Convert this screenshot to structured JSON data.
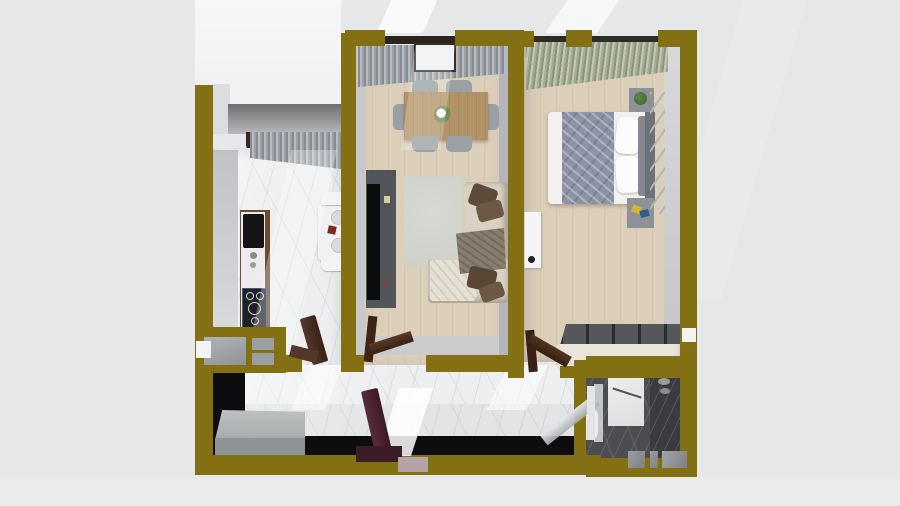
{
  "scene": {
    "title": "3D top-down floor plan render",
    "description": "Photorealistic top-down 3D render of a one-bedroom apartment with thick olive-gold walls, set on a plain light-gray studio background with soft light beams",
    "view": "top-down dollhouse cutaway",
    "no_visible_text": true
  },
  "colors": {
    "bg": "#e6e7e9",
    "wall": "#837012",
    "black": "#0d0d0f",
    "marble": "#eceef0",
    "woodFloor": "#dccfba",
    "darkMarble": "#4c4d50",
    "sofa": "#d9d3c5",
    "pillow": "#5f4b39",
    "rug": "#cdd0c9",
    "tv": "#515459",
    "tableWood": "#b29367",
    "chair": "#9aa0a4",
    "duvet": "#8d93a6",
    "doorBrown": "#46291b",
    "doorMaroon": "#4b2430",
    "bench": "#a9aeae",
    "wardTop": "#55575b",
    "wardFront": "#e9e5db",
    "glass": "#c9ccce",
    "concrete": "#8b8b8d"
  },
  "rooms": {
    "balcony": {
      "label": "Balcony",
      "features": [
        "white floor",
        "concrete parapet edge",
        "dark wood glazed door frames"
      ]
    },
    "kitchen": {
      "label": "Kitchen",
      "features": [
        "counter with black sink and gas cooktop",
        "small white table with two chairs and plates",
        "gray window curtains",
        "olive pass-through window with gray shutters",
        "white marble floor"
      ]
    },
    "living_dining": {
      "label": "Living and dining room",
      "features": [
        "wooden dining table with flower vase",
        "six gray chairs",
        "gray curtains with balcony door",
        "dark TV unit with television",
        "light gray rug",
        "cream corner sofa with brown cushions and gray throw",
        "beige wood floor"
      ]
    },
    "bedroom": {
      "label": "Bedroom",
      "features": [
        "double bed with gray striped duvet and white pillows",
        "two nightstands with plant and books",
        "ladder wall shelf",
        "sliding-door wardrobe",
        "green-gray window curtains",
        "white radiator unit"
      ]
    },
    "hallway": {
      "label": "Hallway",
      "features": [
        "gray storage bench",
        "open maroon entrance door",
        "open brown interior doors",
        "white marble floor",
        "black wainscot band"
      ]
    },
    "bathroom": {
      "label": "Bathroom",
      "features": [
        "dark marble walls and floor",
        "white shower partition",
        "glass swing door",
        "toilet",
        "bottom wall window with three panes"
      ]
    }
  }
}
